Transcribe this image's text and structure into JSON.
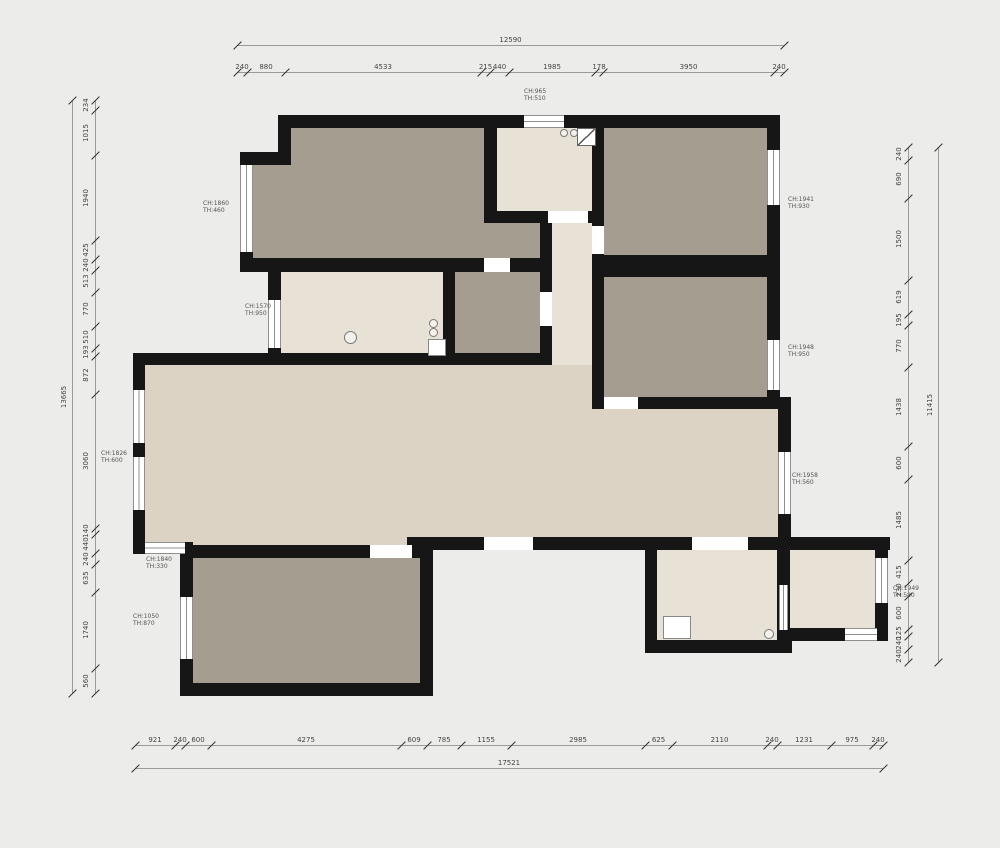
{
  "colors": {
    "background": "#ececeb",
    "dark": "#a49d90",
    "light": "#e8e1d5",
    "living": "#ddd3c5",
    "wall": "#161616",
    "dim_line": "#9a9a9a",
    "dim_text": "#444444",
    "label_text": "#555555"
  },
  "plan": {
    "rooms": [
      {
        "x": 291,
        "y": 128,
        "w": 193,
        "h": 130,
        "tone": "dark",
        "name": "bedroom-top-left"
      },
      {
        "x": 252,
        "y": 165,
        "w": 39,
        "h": 93,
        "tone": "dark",
        "name": "bedroom-top-left-bay"
      },
      {
        "x": 484,
        "y": 223,
        "w": 56,
        "h": 35,
        "tone": "dark",
        "name": "bedroom-top-left-ext"
      },
      {
        "x": 497,
        "y": 128,
        "w": 95,
        "h": 83,
        "tone": "light",
        "name": "entry"
      },
      {
        "x": 604,
        "y": 128,
        "w": 163,
        "h": 127,
        "tone": "dark",
        "name": "bedroom-top-right"
      },
      {
        "x": 281,
        "y": 272,
        "w": 162,
        "h": 81,
        "tone": "light",
        "name": "kitchen"
      },
      {
        "x": 443,
        "y": 272,
        "w": 97,
        "h": 81,
        "tone": "dark",
        "name": "bathroom"
      },
      {
        "x": 604,
        "y": 277,
        "w": 163,
        "h": 120,
        "tone": "dark",
        "name": "bedroom-right"
      },
      {
        "x": 552,
        "y": 223,
        "w": 40,
        "h": 190,
        "tone": "light",
        "name": "corridor"
      },
      {
        "x": 540,
        "y": 365,
        "w": 52,
        "h": 172,
        "tone": "living",
        "name": "hall-junction"
      },
      {
        "x": 145,
        "y": 365,
        "w": 403,
        "h": 180,
        "tone": "living",
        "name": "living-room"
      },
      {
        "x": 548,
        "y": 409,
        "w": 230,
        "h": 128,
        "tone": "living",
        "name": "dining-area"
      },
      {
        "x": 193,
        "y": 558,
        "w": 227,
        "h": 125,
        "tone": "dark",
        "name": "room-bottom-left"
      },
      {
        "x": 657,
        "y": 550,
        "w": 120,
        "h": 90,
        "tone": "light",
        "name": "room-bottom-center"
      },
      {
        "x": 790,
        "y": 550,
        "w": 85,
        "h": 78,
        "tone": "light",
        "name": "room-bottom-right"
      }
    ],
    "walls": [
      [
        278,
        115,
        502,
        13
      ],
      [
        278,
        115,
        13,
        50
      ],
      [
        240,
        152,
        51,
        13
      ],
      [
        240,
        252,
        13,
        12
      ],
      [
        240,
        258,
        244,
        14
      ],
      [
        510,
        258,
        42,
        14
      ],
      [
        484,
        128,
        13,
        95
      ],
      [
        484,
        211,
        64,
        12
      ],
      [
        588,
        211,
        16,
        12
      ],
      [
        592,
        128,
        12,
        98
      ],
      [
        592,
        254,
        12,
        155
      ],
      [
        592,
        255,
        188,
        22
      ],
      [
        592,
        397,
        188,
        12
      ],
      [
        767,
        128,
        13,
        269
      ],
      [
        778,
        397,
        13,
        153
      ],
      [
        268,
        272,
        13,
        93
      ],
      [
        443,
        272,
        12,
        81
      ],
      [
        540,
        223,
        12,
        142
      ],
      [
        133,
        353,
        419,
        12
      ],
      [
        133,
        353,
        12,
        201
      ],
      [
        133,
        542,
        60,
        12
      ],
      [
        180,
        542,
        13,
        16
      ],
      [
        180,
        545,
        240,
        13
      ],
      [
        180,
        558,
        13,
        125
      ],
      [
        180,
        683,
        253,
        13
      ],
      [
        420,
        545,
        13,
        151
      ],
      [
        407,
        537,
        153,
        13
      ],
      [
        548,
        537,
        342,
        13
      ],
      [
        645,
        537,
        12,
        116
      ],
      [
        645,
        640,
        147,
        13
      ],
      [
        777,
        550,
        13,
        90
      ],
      [
        790,
        628,
        98,
        13
      ],
      [
        875,
        537,
        13,
        104
      ]
    ],
    "gaps": [
      [
        548,
        211,
        40,
        12
      ],
      [
        592,
        226,
        12,
        28
      ],
      [
        484,
        258,
        26,
        14
      ],
      [
        604,
        397,
        34,
        12
      ],
      [
        370,
        545,
        42,
        13
      ],
      [
        484,
        537,
        49,
        13
      ],
      [
        692,
        537,
        56,
        13
      ],
      [
        540,
        292,
        12,
        34
      ]
    ],
    "windows": [
      {
        "x": 240,
        "y": 165,
        "w": 13,
        "h": 87,
        "dir": "v"
      },
      {
        "x": 268,
        "y": 300,
        "w": 13,
        "h": 48,
        "dir": "v"
      },
      {
        "x": 133,
        "y": 390,
        "w": 12,
        "h": 53,
        "dir": "v"
      },
      {
        "x": 133,
        "y": 457,
        "w": 12,
        "h": 53,
        "dir": "v"
      },
      {
        "x": 180,
        "y": 597,
        "w": 13,
        "h": 62,
        "dir": "v"
      },
      {
        "x": 767,
        "y": 150,
        "w": 13,
        "h": 55,
        "dir": "v"
      },
      {
        "x": 767,
        "y": 340,
        "w": 13,
        "h": 50,
        "dir": "v"
      },
      {
        "x": 778,
        "y": 452,
        "w": 13,
        "h": 62,
        "dir": "v"
      },
      {
        "x": 875,
        "y": 558,
        "w": 13,
        "h": 45,
        "dir": "v"
      },
      {
        "x": 779,
        "y": 585,
        "w": 9,
        "h": 45,
        "dir": "v"
      },
      {
        "x": 524,
        "y": 115,
        "w": 40,
        "h": 13,
        "dir": "h"
      },
      {
        "x": 145,
        "y": 542,
        "w": 40,
        "h": 12,
        "dir": "h"
      },
      {
        "x": 845,
        "y": 628,
        "w": 32,
        "h": 13,
        "dir": "h"
      }
    ],
    "fixtures": [
      {
        "type": "circle",
        "x": 344,
        "y": 331,
        "d": 11,
        "name": "kitchen-sink"
      },
      {
        "type": "circle",
        "x": 429,
        "y": 319,
        "d": 7,
        "name": "stove-burner"
      },
      {
        "type": "circle",
        "x": 429,
        "y": 328,
        "d": 7,
        "name": "stove-burner"
      },
      {
        "type": "rect",
        "x": 428,
        "y": 339,
        "w": 16,
        "h": 15,
        "name": "kitchen-counter"
      },
      {
        "type": "rect",
        "x": 663,
        "y": 616,
        "w": 26,
        "h": 21,
        "name": "fixture-box"
      },
      {
        "type": "circle",
        "x": 764,
        "y": 629,
        "d": 8,
        "name": "drain"
      },
      {
        "type": "leaf",
        "x": 577,
        "y": 128,
        "w": 17,
        "h": 16,
        "name": "entry-door-leaf"
      },
      {
        "type": "circle",
        "x": 560,
        "y": 129,
        "d": 6,
        "name": "door-detail"
      },
      {
        "type": "circle",
        "x": 570,
        "y": 129,
        "d": 6,
        "name": "door-detail"
      }
    ],
    "window_labels": [
      {
        "x": 203,
        "y": 200,
        "ch": "CH:1860",
        "th": "TH:460"
      },
      {
        "x": 245,
        "y": 303,
        "ch": "CH:1570",
        "th": "TH:950"
      },
      {
        "x": 101,
        "y": 450,
        "ch": "CH:1826",
        "th": "TH:600"
      },
      {
        "x": 146,
        "y": 556,
        "ch": "CH:1840",
        "th": "TH:330"
      },
      {
        "x": 133,
        "y": 613,
        "ch": "CH:1050",
        "th": "TH:870"
      },
      {
        "x": 524,
        "y": 88,
        "ch": "CH:965",
        "th": "TH:510"
      },
      {
        "x": 788,
        "y": 196,
        "ch": "CH:1941",
        "th": "TH:930"
      },
      {
        "x": 788,
        "y": 344,
        "ch": "CH:1948",
        "th": "TH:950"
      },
      {
        "x": 792,
        "y": 472,
        "ch": "CH:1958",
        "th": "TH:560"
      },
      {
        "x": 893,
        "y": 585,
        "ch": "CH:1949",
        "th": "TH:580"
      }
    ]
  },
  "dimensions": {
    "top": {
      "orient": "h",
      "line": 72,
      "overall_line": 45,
      "start": 237,
      "overall": "12590",
      "segments": [
        [
          "240",
          10
        ],
        [
          "880",
          38
        ],
        [
          "4533",
          196
        ],
        [
          "215",
          9
        ],
        [
          "440",
          19
        ],
        [
          "1985",
          86
        ],
        [
          "178",
          8
        ],
        [
          "3950",
          171
        ],
        [
          "240",
          10
        ]
      ]
    },
    "bottom": {
      "orient": "h",
      "line": 745,
      "overall_line": 768,
      "start": 135,
      "overall": "17521",
      "segments": [
        [
          "921",
          40
        ],
        [
          "240",
          10
        ],
        [
          "600",
          26
        ],
        [
          "4275",
          190
        ],
        [
          "609",
          26
        ],
        [
          "785",
          34
        ],
        [
          "1155",
          50
        ],
        [
          "2985",
          134
        ],
        [
          "625",
          27
        ],
        [
          "2110",
          95
        ],
        [
          "240",
          10
        ],
        [
          "1231",
          54
        ],
        [
          "975",
          42
        ],
        [
          "240",
          10
        ]
      ]
    },
    "left": {
      "orient": "v",
      "line": 95,
      "overall_line": 72,
      "start": 100,
      "overall": "13665",
      "segments": [
        [
          "234",
          10
        ],
        [
          "1015",
          45
        ],
        [
          "1940",
          85
        ],
        [
          "425",
          19
        ],
        [
          "240",
          11
        ],
        [
          "513",
          22
        ],
        [
          "770",
          34
        ],
        [
          "510",
          22
        ],
        [
          "193",
          8
        ],
        [
          "872",
          38
        ],
        [
          "3060",
          134
        ],
        [
          "140",
          6
        ],
        [
          "440",
          19
        ],
        [
          "240",
          11
        ],
        [
          "635",
          28
        ],
        [
          "1740",
          76
        ],
        [
          "560",
          25
        ]
      ]
    },
    "right": {
      "orient": "v",
      "line": 908,
      "overall_line": 938,
      "start": 147,
      "overall": "11415",
      "segments": [
        [
          "240",
          13
        ],
        [
          "690",
          38
        ],
        [
          "1500",
          82
        ],
        [
          "619",
          34
        ],
        [
          "195",
          11
        ],
        [
          "770",
          42
        ],
        [
          "1438",
          79
        ],
        [
          "600",
          33
        ],
        [
          "1485",
          81
        ],
        [
          "415",
          23
        ],
        [
          "230",
          13
        ],
        [
          "600",
          33
        ],
        [
          "125",
          7
        ],
        [
          "240",
          13
        ],
        [
          "240",
          13
        ]
      ]
    }
  }
}
